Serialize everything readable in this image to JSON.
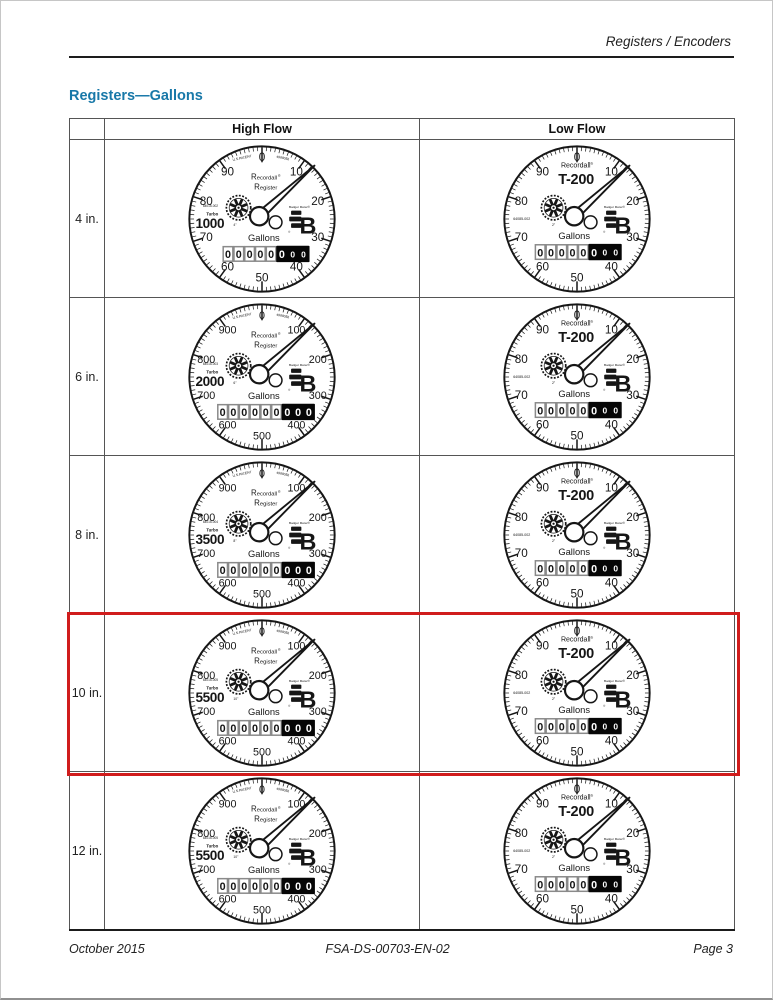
{
  "page": {
    "header_right": "Registers / Encoders",
    "title": "Registers—Gallons",
    "footer": {
      "left": "October 2015",
      "center": "FSA-DS-00703-EN-02",
      "right": "Page 3"
    }
  },
  "colors": {
    "title_blue": "#1878A8",
    "highlight_red": "#D01C1C",
    "ink": "#161616"
  },
  "table": {
    "columns": [
      "High Flow",
      "Low Flow"
    ],
    "rows": [
      {
        "label": "4 in.",
        "highlighted": false,
        "high_flow": {
          "model_type": "turbo",
          "scale_labels": [
            "0",
            "10",
            "20",
            "30",
            "40",
            "50",
            "60",
            "70",
            "80",
            "90"
          ],
          "patent_left": "U.S.PATENT",
          "patent_right": "4988056",
          "brand_line1": "Recordall",
          "trademark": "®",
          "brand_line2": "Register",
          "part_number": "64015-002",
          "series_label": "Turbo",
          "series_value": "1000",
          "size_label": "4\"",
          "units": "Gallons",
          "logo_text": "Badger Meter",
          "odometer": {
            "white_digits": [
              "0",
              "0",
              "0",
              "0",
              "0"
            ],
            "black_digits": [
              "0",
              "0",
              "0"
            ],
            "black_small_tail": true
          }
        },
        "low_flow": {
          "model_type": "t200",
          "scale_labels": [
            "0",
            "10",
            "20",
            "30",
            "40",
            "50",
            "60",
            "70",
            "80",
            "90"
          ],
          "brand_line1": "Recordall",
          "trademark": "®",
          "model": "T-200",
          "part_number": "64085-002",
          "size_label": "2\"",
          "units": "Gallons",
          "logo_text": "Badger Meter",
          "odometer": {
            "white_digits": [
              "0",
              "0",
              "0",
              "0",
              "0"
            ],
            "black_digits": [
              "0",
              "0",
              "0"
            ],
            "black_small_tail": true
          }
        }
      },
      {
        "label": "6 in.",
        "highlighted": false,
        "high_flow": {
          "model_type": "turbo",
          "scale_labels": [
            "0",
            "100",
            "200",
            "300",
            "400",
            "500",
            "600",
            "700",
            "800",
            "900"
          ],
          "patent_left": "U.S.PATENT",
          "patent_right": "4988056",
          "brand_line1": "Recordall",
          "trademark": "®",
          "brand_line2": "Register",
          "part_number": "64015-003",
          "series_label": "Turbo",
          "series_value": "2000",
          "size_label": "6\"",
          "units": "Gallons",
          "logo_text": "Badger Meter",
          "odometer": {
            "white_digits": [
              "0",
              "0",
              "0",
              "0",
              "0",
              "0"
            ],
            "black_digits": [
              "0",
              "0",
              "0"
            ],
            "black_small_tail": false
          }
        },
        "low_flow": {
          "model_type": "t200",
          "scale_labels": [
            "0",
            "10",
            "20",
            "30",
            "40",
            "50",
            "60",
            "70",
            "80",
            "90"
          ],
          "brand_line1": "Recordall",
          "trademark": "®",
          "model": "T-200",
          "part_number": "64085-002",
          "size_label": "2\"",
          "units": "Gallons",
          "logo_text": "Badger Meter",
          "odometer": {
            "white_digits": [
              "0",
              "0",
              "0",
              "0",
              "0"
            ],
            "black_digits": [
              "0",
              "0",
              "0"
            ],
            "black_small_tail": true
          }
        }
      },
      {
        "label": "8 in.",
        "highlighted": false,
        "high_flow": {
          "model_type": "turbo",
          "scale_labels": [
            "0",
            "100",
            "200",
            "300",
            "400",
            "500",
            "600",
            "700",
            "800",
            "900"
          ],
          "patent_left": "U.S.PATENT",
          "patent_right": "4988056",
          "brand_line1": "Recordall",
          "trademark": "®",
          "brand_line2": "Register",
          "part_number": "64015-004",
          "series_label": "Turbo",
          "series_value": "3500",
          "size_label": "8\"",
          "units": "Gallons",
          "logo_text": "Badger Meter",
          "odometer": {
            "white_digits": [
              "0",
              "0",
              "0",
              "0",
              "0",
              "0"
            ],
            "black_digits": [
              "0",
              "0",
              "0"
            ],
            "black_small_tail": false
          }
        },
        "low_flow": {
          "model_type": "t200",
          "scale_labels": [
            "0",
            "10",
            "20",
            "30",
            "40",
            "50",
            "60",
            "70",
            "80",
            "90"
          ],
          "brand_line1": "Recordall",
          "trademark": "®",
          "model": "T-200",
          "part_number": "64085-002",
          "size_label": "2\"",
          "units": "Gallons",
          "logo_text": "Badger Meter",
          "odometer": {
            "white_digits": [
              "0",
              "0",
              "0",
              "0",
              "0"
            ],
            "black_digits": [
              "0",
              "0",
              "0"
            ],
            "black_small_tail": true
          }
        }
      },
      {
        "label": "10 in.",
        "highlighted": true,
        "high_flow": {
          "model_type": "turbo",
          "scale_labels": [
            "0",
            "100",
            "200",
            "300",
            "400",
            "500",
            "600",
            "700",
            "800",
            "900"
          ],
          "patent_left": "U.S.PATENT",
          "patent_right": "4988056",
          "brand_line1": "Recordall",
          "trademark": "®",
          "brand_line2": "Register",
          "part_number": "64015-005",
          "series_label": "Turbo",
          "series_value": "5500",
          "size_label": "10\"",
          "units": "Gallons",
          "logo_text": "Badger Meter",
          "odometer": {
            "white_digits": [
              "0",
              "0",
              "0",
              "0",
              "0",
              "0"
            ],
            "black_digits": [
              "0",
              "0",
              "0"
            ],
            "black_small_tail": false
          }
        },
        "low_flow": {
          "model_type": "t200",
          "scale_labels": [
            "0",
            "10",
            "20",
            "30",
            "40",
            "50",
            "60",
            "70",
            "80",
            "90"
          ],
          "brand_line1": "Recordall",
          "trademark": "®",
          "model": "T-200",
          "part_number": "64085-002",
          "size_label": "2\"",
          "units": "Gallons",
          "logo_text": "Badger Meter",
          "odometer": {
            "white_digits": [
              "0",
              "0",
              "0",
              "0",
              "0"
            ],
            "black_digits": [
              "0",
              "0",
              "0"
            ],
            "black_small_tail": true
          }
        }
      },
      {
        "label": "12 in.",
        "highlighted": false,
        "high_flow": {
          "model_type": "turbo",
          "scale_labels": [
            "0",
            "100",
            "200",
            "300",
            "400",
            "500",
            "600",
            "700",
            "800",
            "900"
          ],
          "patent_left": "U.S.PATENT",
          "patent_right": "4988056",
          "brand_line1": "Recordall",
          "trademark": "®",
          "brand_line2": "Register",
          "part_number": "64015-005",
          "series_label": "Turbo",
          "series_value": "5500",
          "size_label": "10\"",
          "units": "Gallons",
          "logo_text": "Badger Meter",
          "odometer": {
            "white_digits": [
              "0",
              "0",
              "0",
              "0",
              "0",
              "0"
            ],
            "black_digits": [
              "0",
              "0",
              "0"
            ],
            "black_small_tail": false
          }
        },
        "low_flow": {
          "model_type": "t200",
          "scale_labels": [
            "0",
            "10",
            "20",
            "30",
            "40",
            "50",
            "60",
            "70",
            "80",
            "90"
          ],
          "brand_line1": "Recordall",
          "trademark": "®",
          "model": "T-200",
          "part_number": "64085-002",
          "size_label": "2\"",
          "units": "Gallons",
          "logo_text": "Badger Meter",
          "odometer": {
            "white_digits": [
              "0",
              "0",
              "0",
              "0",
              "0"
            ],
            "black_digits": [
              "0",
              "0",
              "0"
            ],
            "black_small_tail": true
          }
        }
      }
    ]
  }
}
